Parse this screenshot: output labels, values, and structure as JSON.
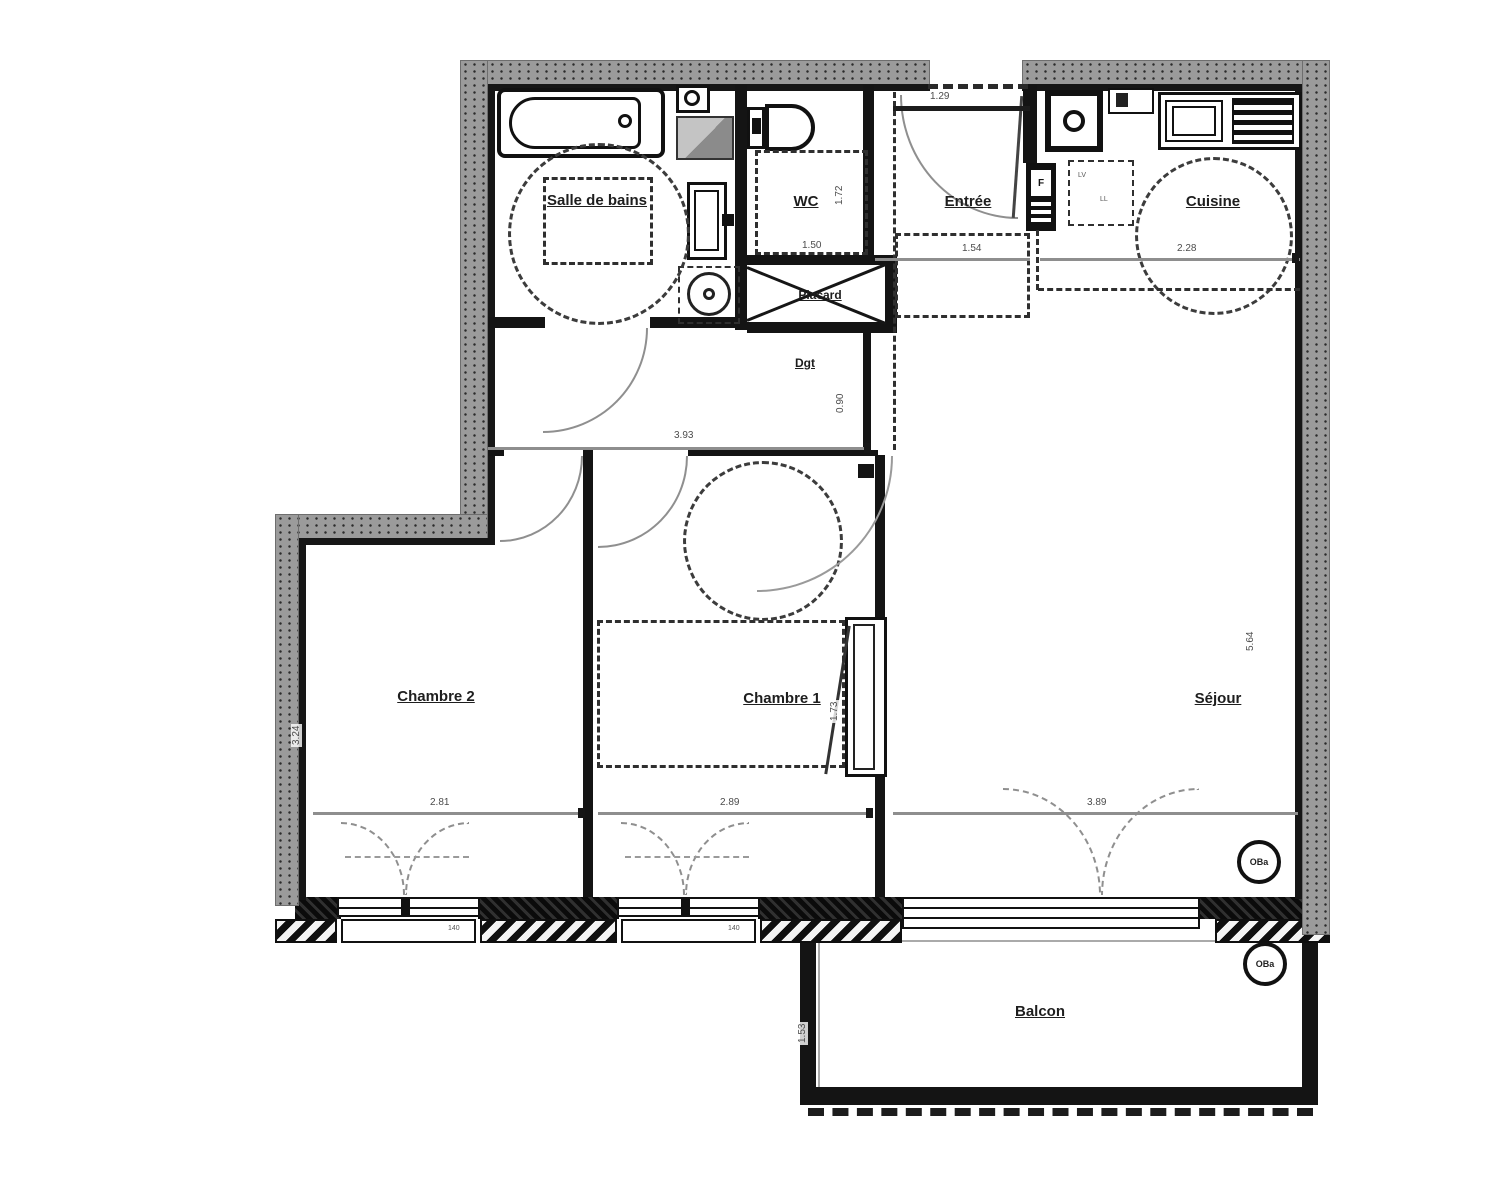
{
  "plan": {
    "rooms": [
      {
        "id": "salle-de-bains",
        "label": "Salle de bains"
      },
      {
        "id": "wc",
        "label": "WC"
      },
      {
        "id": "entree",
        "label": "Entrée"
      },
      {
        "id": "cuisine",
        "label": "Cuisine"
      },
      {
        "id": "placard",
        "label": "Placard"
      },
      {
        "id": "dgt",
        "label": "Dgt"
      },
      {
        "id": "chambre2",
        "label": "Chambre 2"
      },
      {
        "id": "chambre1",
        "label": "Chambre 1"
      },
      {
        "id": "sejour",
        "label": "Séjour"
      },
      {
        "id": "balcon",
        "label": "Balcon"
      }
    ],
    "dimensions": {
      "entree_door_width": "1.29",
      "entree_width": "1.54",
      "wc_width": "1.50",
      "wc_depth": "1.72",
      "cuisine_width": "2.28",
      "dgt_length": "3.93",
      "dgt_door": "0.90",
      "chambre2_width": "2.81",
      "chambre2_depth": "3.24",
      "chambre1_width": "2.89",
      "wardrobe_depth": "1.73",
      "sejour_width": "3.89",
      "sejour_depth": "5.64",
      "balcon_depth": "1.53",
      "chambre2_window": "140",
      "chambre1_window": "140"
    },
    "markers": {
      "sejour": "OBa",
      "balcon": "OBa"
    },
    "labels": {
      "fridge": "F",
      "lv": "LV",
      "ll": "LL"
    }
  }
}
